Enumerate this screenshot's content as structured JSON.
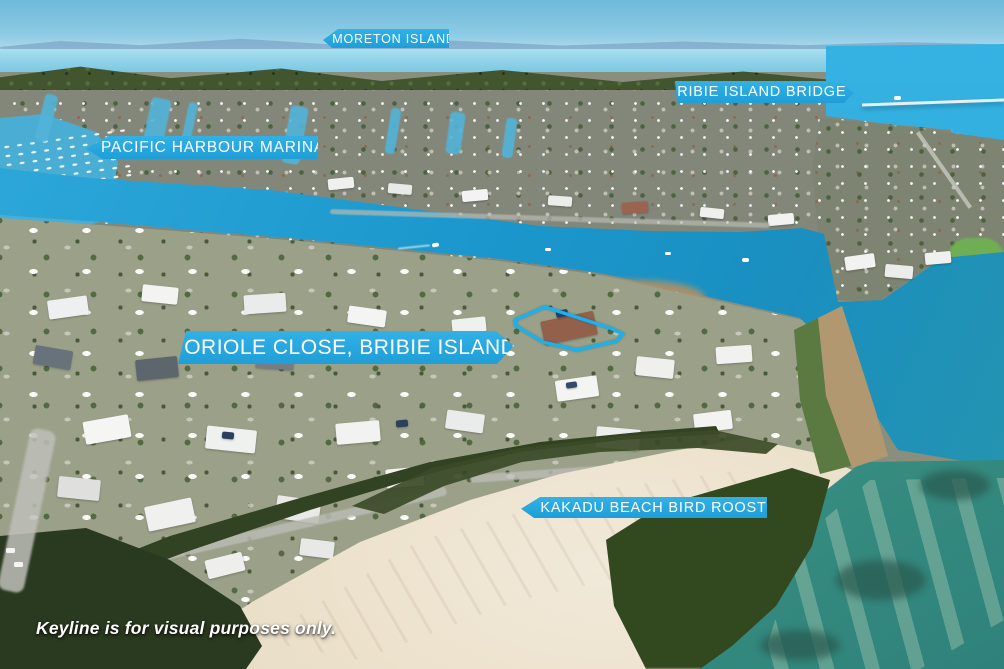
{
  "meta": {
    "type": "aerial-property-marketing-photo",
    "location_context": "Bribie Island waterfront, Pacific Harbour canal estate"
  },
  "labels": {
    "moreton_island": "MORETON ISLAND",
    "bribie_island_bridge": "BRIBIE ISLAND BRIDGE",
    "pacific_harbour_marina": "PACIFIC HARBOUR MARINA",
    "property_address": "7 ORIOLE CLOSE, BRIBIE ISLAND",
    "kakadu_beach_bird_roost": "KAKADU BEACH BIRD ROOST"
  },
  "footnote": "Keyline is for visual purposes only.",
  "keyline": {
    "points": "515,320 545,307 610,328 623,334 617,341 577,350 543,342 516,326",
    "color": "#17b3f0",
    "stroke_width": "3.3"
  },
  "colors": {
    "banner_blue": "#29abe2",
    "label_text": "#ffffff",
    "canal_water": "#1b97cd",
    "shallow_green_water": "#3d9383",
    "sand": "#e8dcc3"
  }
}
